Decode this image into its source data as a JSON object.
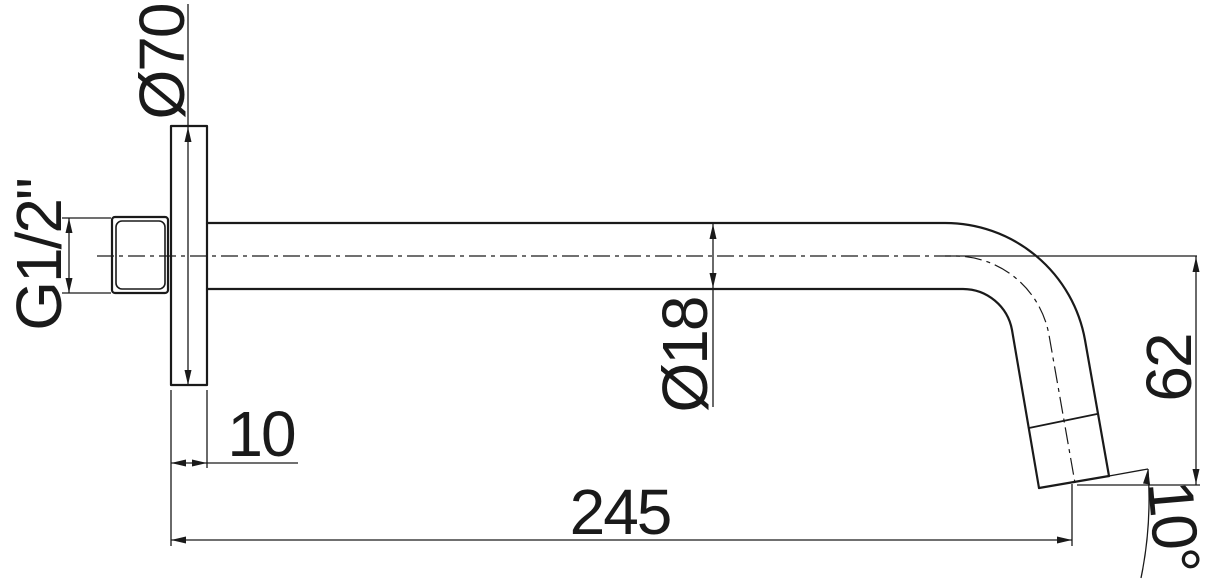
{
  "drawing": {
    "background_color": "#ffffff",
    "line_color": "#1a1a1a",
    "labels": {
      "flange_diameter": "Ø70",
      "thread_size": "G1/2\"",
      "flange_thickness": "10",
      "projection_length": "245",
      "pipe_diameter": "Ø18",
      "drop_height": "62",
      "outlet_angle": "10°"
    }
  }
}
